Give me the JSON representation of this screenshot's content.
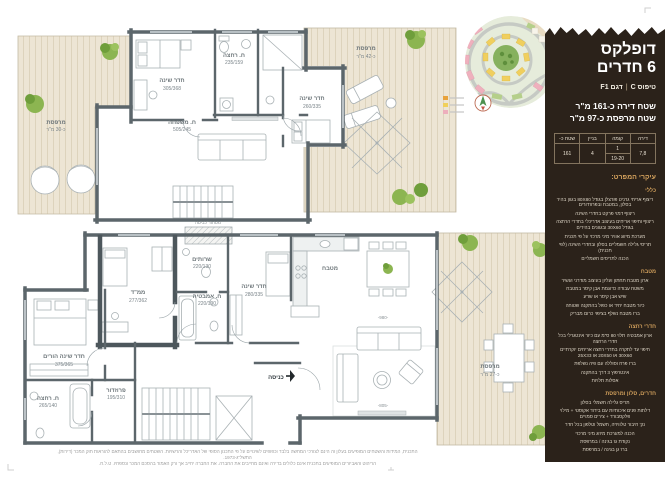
{
  "sidebar": {
    "bg": "#2b221a",
    "accent": "#d2a05c",
    "title_line1": "דופלקס",
    "title_line2": "6 חדרים",
    "type_label": "טיפוס C",
    "model_label": "דגם F1",
    "area_apartment": "שטח דירה כ-161 מ\"ר",
    "area_balcony": "שטח מרפסת כ-97 מ\"ר",
    "table": {
      "col_apartment": "דירה",
      "col_floor": "קומה",
      "col_building": "בניין",
      "col_area": "שטח כ-",
      "val_apartment": "7,8",
      "val_floor_top": "1",
      "val_floor_bottom": "19-20",
      "val_building": "4",
      "val_area": "161"
    },
    "specs_heading": "עיקרי המפרט:",
    "sections": [
      {
        "title": "כללי",
        "items": [
          "ריצוף אריחי גרניט פורצלן בגודל 80X80 בגוון בהיר בסלון, במטבח ובפרוזדורים",
          "ריצוף דמוי פרקט בחדרי השינה",
          "ריצוף וחיפוי אריחים בעיצוב אדריכלי בחדרי הרחצה בגודל 30X60 ובגוונים בהירים",
          "מערכת מיזוג אוויר מיני מרכזי על פי תכנית",
          "תריסי גלילה חשמליים בסלון ובחדרי השינה (לפי תכנית)",
          "הכנה לתריסים חשמליים"
        ]
      },
      {
        "title": "מטבח",
        "items": [
          "ארון מטבח תחתון ועליון בעיצוב מודרני ועשיר",
          "משטח עבודה כדוגמת אבן קיסר במטבח",
          "שיש אבן קיסר או שו\"ע",
          "כיור מטבח יחיד או כפול בהתקנה שטוחה",
          "ברז מטבח נשלף בציפוי כרום מבריק"
        ]
      },
      {
        "title": "חדרי רחצה",
        "items": [
          "ארון אמבטיה תלוי 80 ס\"מ עם כיור אינטגרלי בכל חדרי הרחצה",
          "חיפוי עד לתקרה בחדרי רחצה אריחים יוקרתיים 30X60 או 20X50 או 25X33",
          "ברז פרח וסוללה עם פיה נשלפת",
          "אינטרפוץ 3 דרך בהתקנה",
          "אסלות תלויות"
        ]
      },
      {
        "title": "חדרים, סלון ומרפסת",
        "items": [
          "תריס גלילה חשמלי בסלון",
          "דלתות פנים איכותיות עם בידוד אקוסטי + מילוי פלקסבורד + צירים סמויים",
          "נק' חיבור טלוויזיה, חשמל וטלפון בכל חדר",
          "הכנה למערכת מיזוג מיני מרכזי",
          "נקודת גז בגינה / במרפסת",
          "ברז גן בגינה / במרפסת"
        ]
      }
    ]
  },
  "plans": {
    "upper": {
      "rooms": [
        {
          "name": "חדר שינה",
          "dim": "305/368"
        },
        {
          "name": "ח. רחצה",
          "dim": "235/159"
        },
        {
          "name": "ח. משפחה",
          "dim": "505/245"
        },
        {
          "name": "חדר שינה",
          "dim": "260/335"
        },
        {
          "name": "מרפסת",
          "dim": "כ-42 מ\"ר"
        },
        {
          "name": "מרפסת",
          "dim": "כ-30 מ\"ר"
        }
      ]
    },
    "lower": {
      "rooms": [
        {
          "name": "ממ\"ד",
          "dim": "277/362"
        },
        {
          "name": "שרותים",
          "dim": "220/130"
        },
        {
          "name": "ח. אמבטיה",
          "dim": "220/190"
        },
        {
          "name": "חדר שינה",
          "dim": "280/335"
        },
        {
          "name": "חדר שינה הורים",
          "dim": "375/365"
        },
        {
          "name": "ח. רחצה",
          "dim": "265/140"
        },
        {
          "name": "פרוזדור",
          "dim": "195/310"
        },
        {
          "name": "מטבח",
          "dim": ""
        },
        {
          "name": "מרפסת",
          "dim": "כ-27 מ\"ר"
        },
        {
          "name": "מסתור כביסה",
          "dim": ""
        },
        {
          "name": "כניסה",
          "dim": ""
        }
      ],
      "dims": {
        "living_w": "-980-",
        "living_h": "-805-"
      }
    }
  },
  "legend": {
    "colors": [
      "#e8a23b",
      "#f0d05a",
      "#edafbc"
    ]
  },
  "disclaimer": {
    "line1": "התכנית, המידות והשטחים המופיעים בעלון זה הינם לצורכי המחשה בלבד וכפופים לשינויים על פי התכנון הסופי של האדריכל והרשויות. השטחים מחושבים בהתאם להוראות חוק המכר (דירות), התשל\"ג-1973.",
    "line2": "הריהוט והאביזרים המופיעים בתכנית אינם כלולים בדירה ואינם מחייבים את החברה. את החברה יחייב אך ורק האמור בהסכם המכר ונספחיו. ט.ל.ח."
  }
}
